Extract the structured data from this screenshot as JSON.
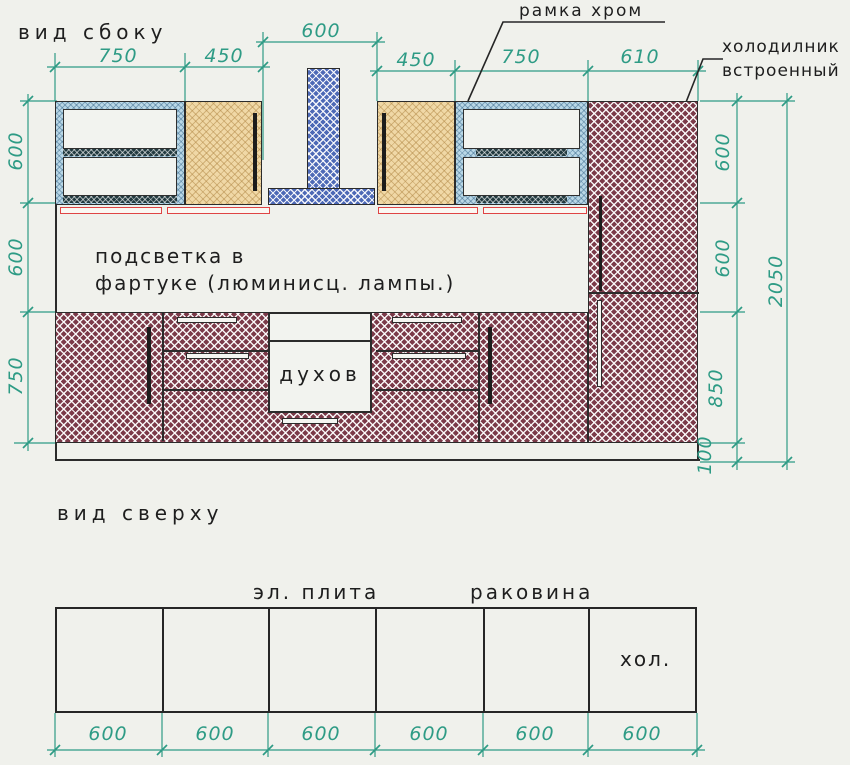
{
  "side_view": {
    "title": "вид сбоку",
    "annotations": {
      "chrome_frame": "рамка хром",
      "fridge_line1": "холодилник",
      "fridge_line2": "встроенный",
      "backsplash_line1": "подсветка в",
      "backsplash_line2": "фартуке (люминисц. лампы.)",
      "oven": "духов"
    },
    "dims_top": [
      "750",
      "450",
      "600",
      "450",
      "750",
      "610"
    ],
    "dims_left": [
      "600",
      "600",
      "750"
    ],
    "dims_right": [
      "600",
      "600",
      "850",
      "100"
    ],
    "dim_total_height": "2050"
  },
  "top_view": {
    "title": "вид сверху",
    "labels": {
      "stove": "эл. плита",
      "sink": "раковина",
      "fridge": "хол."
    },
    "dims_bottom": [
      "600",
      "600",
      "600",
      "600",
      "600",
      "600"
    ]
  },
  "colors": {
    "dimension": "#2e9b85",
    "outline": "#262626",
    "maroon_hatch": "#7b3a49",
    "tan_hatch": "#f0d8a6",
    "blue_hatch": "#4d69b6",
    "chrome_frame_hatch": "#b9d7e6",
    "light_strip_red": "#df4444",
    "background": "#f0f1ec"
  }
}
